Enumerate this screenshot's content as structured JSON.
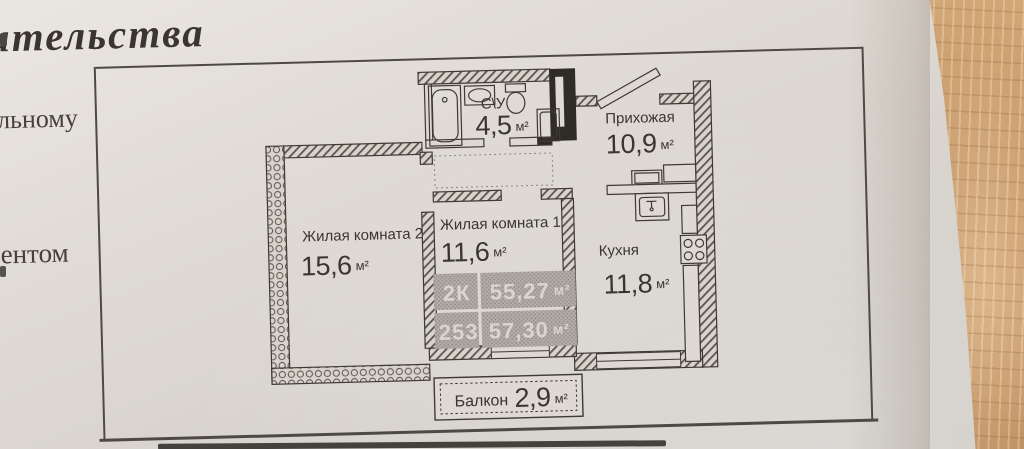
{
  "document": {
    "heading_fragment": "ительства",
    "left_cells": {
      "line1": "льному",
      "line2": "ентом"
    }
  },
  "plan": {
    "rooms": {
      "bathroom": {
        "name": "С\\У",
        "area": "4,5",
        "unit": "м²"
      },
      "hallway": {
        "name": "Прихожая",
        "area": "10,9",
        "unit": "м²"
      },
      "living2": {
        "name": "Жилая комната 2",
        "area": "15,6",
        "unit": "м²"
      },
      "living1": {
        "name": "Жилая комната 1",
        "area": "11,6",
        "unit": "м²"
      },
      "kitchen": {
        "name": "Кухня",
        "area": "11,8",
        "unit": "м²"
      },
      "balcony": {
        "name": "Балкон",
        "area": "2,9",
        "unit": "м²"
      }
    },
    "stamp": {
      "flat_type": "2К",
      "area1": "55,27",
      "area1_unit": "м²",
      "flat_no": "253",
      "area2": "57,30",
      "area2_unit": "м²"
    }
  },
  "colors": {
    "paper": "#ded9d3",
    "ink": "#3a362f",
    "wood": "#c79969",
    "stamp_gray": "#b3aea7"
  }
}
